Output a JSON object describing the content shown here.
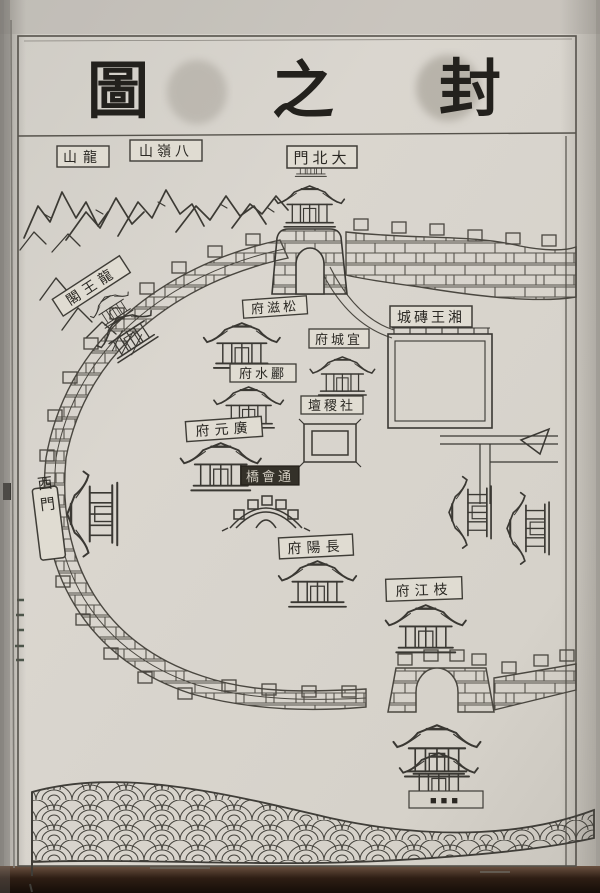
{
  "page": {
    "title_chars": [
      "圖",
      "之",
      "封"
    ]
  },
  "labels": {
    "longshan": "山龍",
    "balingshan": "山嶺八",
    "da_bei_men": "門北大",
    "longwang_ge": "閣王龍",
    "songzi_fu": "府滋松",
    "yicheng_fu": "府城宜",
    "lishui_fu": "府水酈",
    "sheji_tan": "壇稷社",
    "guangyuan_fu": "府元廣",
    "tonghui_qiao": "橋會通",
    "xiangwang_zhuancheng": "城磚王湘",
    "changyang_fu": "府陽長",
    "zhijiang_fu": "府江枝",
    "xi_men": "西門",
    "illegible_bottom": "■■■"
  },
  "colors": {
    "paper": "#d8d4cc",
    "ink": "#3a3833",
    "dark_label_bg": "#343129",
    "photo_edge": "#1c120c"
  }
}
